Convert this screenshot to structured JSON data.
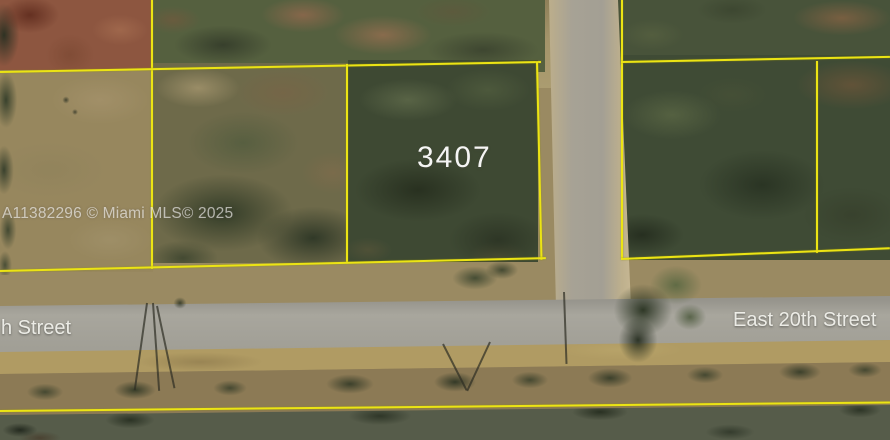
{
  "map": {
    "parcel_number": "3407",
    "watermark": "A11382296 © Miami MLS© 2025",
    "streets": {
      "left_partial": "h Street",
      "right": "East 20th Street"
    },
    "colors": {
      "parcel_line": "#ece414",
      "road": "#a3a198",
      "water": "#565c4a",
      "field": "#97875e",
      "trees": "#3f4b35"
    }
  }
}
